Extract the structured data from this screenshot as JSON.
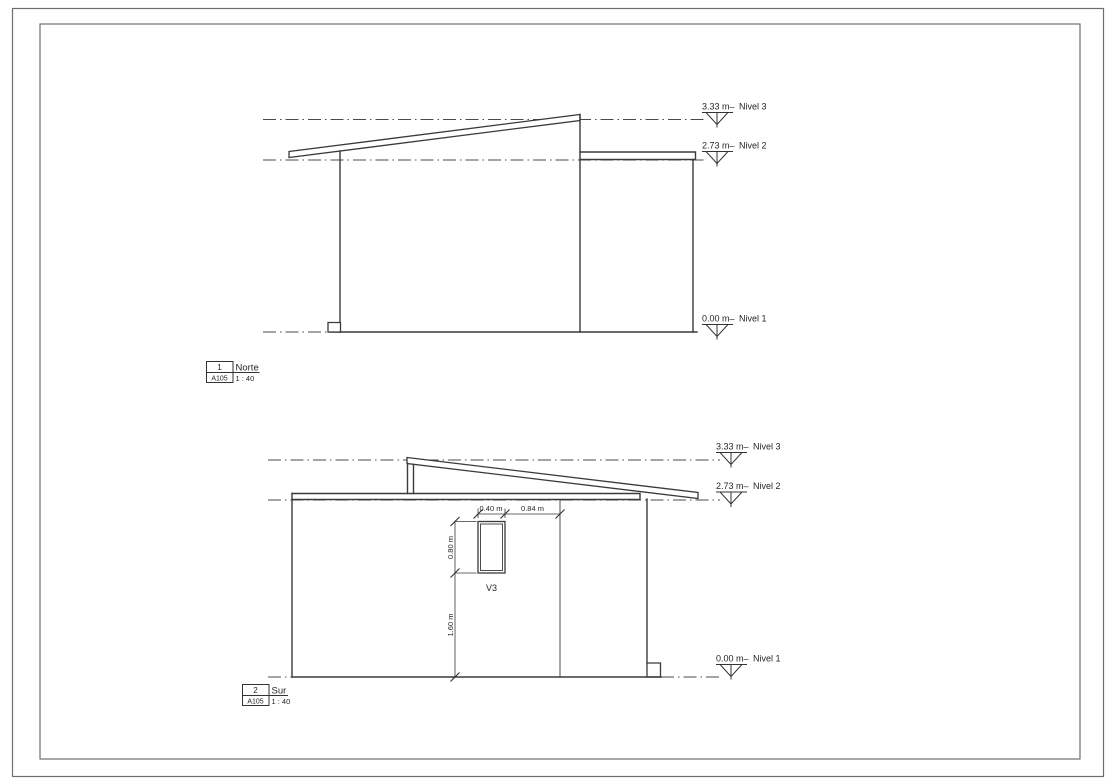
{
  "colors": {
    "line": "#3a3a3a",
    "background": "#ffffff"
  },
  "views": [
    {
      "number": "1",
      "sheet": "A105",
      "name": "Norte",
      "scale": "1 : 40",
      "levels": [
        {
          "elevation": "3.33 m–",
          "name": "Nivel 3"
        },
        {
          "elevation": "2.73 m–",
          "name": "Nivel 2"
        },
        {
          "elevation": "0.00 m–",
          "name": "Nivel 1"
        }
      ]
    },
    {
      "number": "2",
      "sheet": "A105",
      "name": "Sur",
      "scale": "1 : 40",
      "levels": [
        {
          "elevation": "3.33 m–",
          "name": "Nivel 3"
        },
        {
          "elevation": "2.73 m–",
          "name": "Nivel 2"
        },
        {
          "elevation": "0.00 m–",
          "name": "Nivel 1"
        }
      ],
      "window": {
        "label": "V3",
        "width": "0.40 m",
        "distance_to_wall": "0.84 m",
        "height": "0.80 m",
        "sill_height": "1.60 m"
      }
    }
  ]
}
